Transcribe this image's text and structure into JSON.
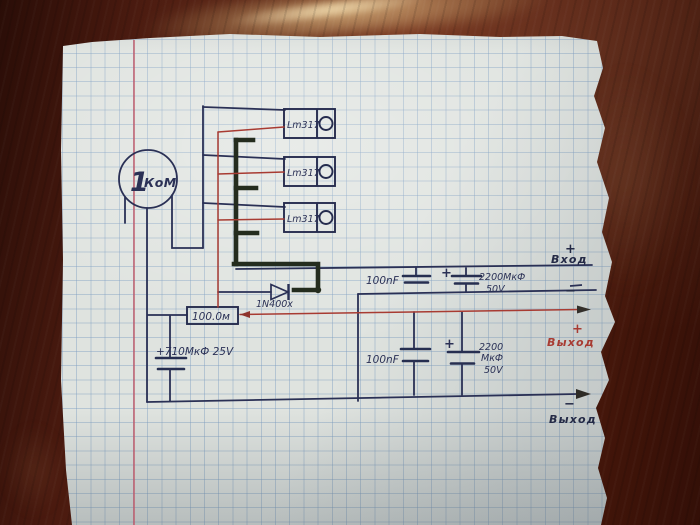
{
  "colors": {
    "paper": "#dfe3df",
    "wood_table": "#5a2315",
    "grid_line": "#7a9ac0",
    "margin_line": "#c05a6a",
    "ink_blue": "#2a3055",
    "ink_red": "#a83b32",
    "ink_green_black": "#242c1e"
  },
  "schematic": {
    "potentiometer": {
      "value": "1",
      "unit": "КоМ"
    },
    "regulators": {
      "labels": [
        "Lm317",
        "Lm317",
        "Lm317"
      ]
    },
    "diode": {
      "label": "1N400x"
    },
    "series_resistor": {
      "label": "100.0м"
    },
    "bulk_capacitor": {
      "label": "+710МкФ 25V"
    },
    "input_filter": {
      "small_cap": "100nF",
      "large_cap_plus": "+",
      "large_cap_value": "2200МкФ",
      "large_cap_voltage": "50V"
    },
    "output_filter": {
      "small_cap": "100nF",
      "large_cap_plus": "+",
      "large_cap_value": "2200",
      "large_cap_unit": "МкФ",
      "large_cap_voltage": "50V"
    },
    "terminals": {
      "input_plus_sign": "+",
      "input_label": "Вход",
      "input_minus_sign": "−",
      "output_plus_sign": "+",
      "output_plus_label": "Выход",
      "output_minus_sign": "−",
      "output_minus_label": "Выход"
    }
  }
}
